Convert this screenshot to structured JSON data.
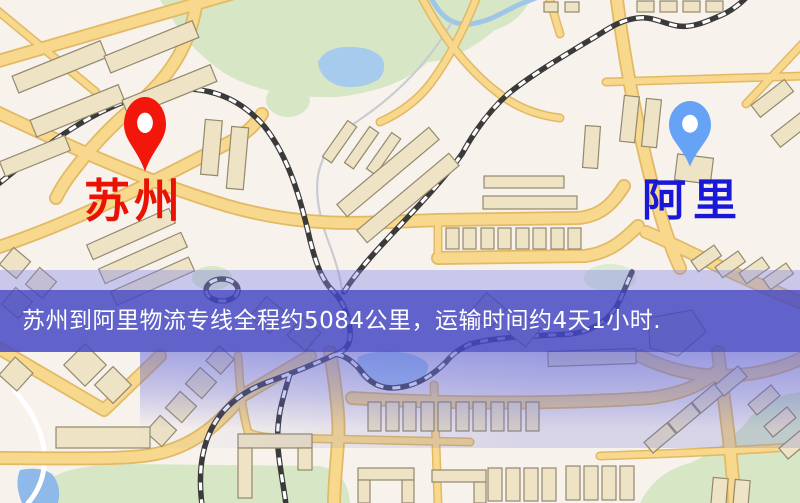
{
  "markers": [
    {
      "id": "origin",
      "label": "苏州",
      "pin_icon": "map-pin-icon",
      "pin_color": "#f2170a",
      "label_color": "#ea1203"
    },
    {
      "id": "destination",
      "label": "阿里",
      "pin_icon": "map-pin-icon",
      "pin_color": "#66a2f5",
      "label_color": "#1a18d8"
    }
  ],
  "banner": {
    "text": "苏州到阿里物流专线全程约5084公里，运输时间约4天1小时.",
    "background_color": "#4448c4",
    "text_color": "#ffffff"
  },
  "map_palette": {
    "background": "#f8f2ec",
    "road_fill": "#f7d88d",
    "road_edge": "#e2b964",
    "park": "#d7e7c5",
    "water": "#a6cbed",
    "building": "#eee3c4",
    "railway": "#3a3a3a"
  }
}
